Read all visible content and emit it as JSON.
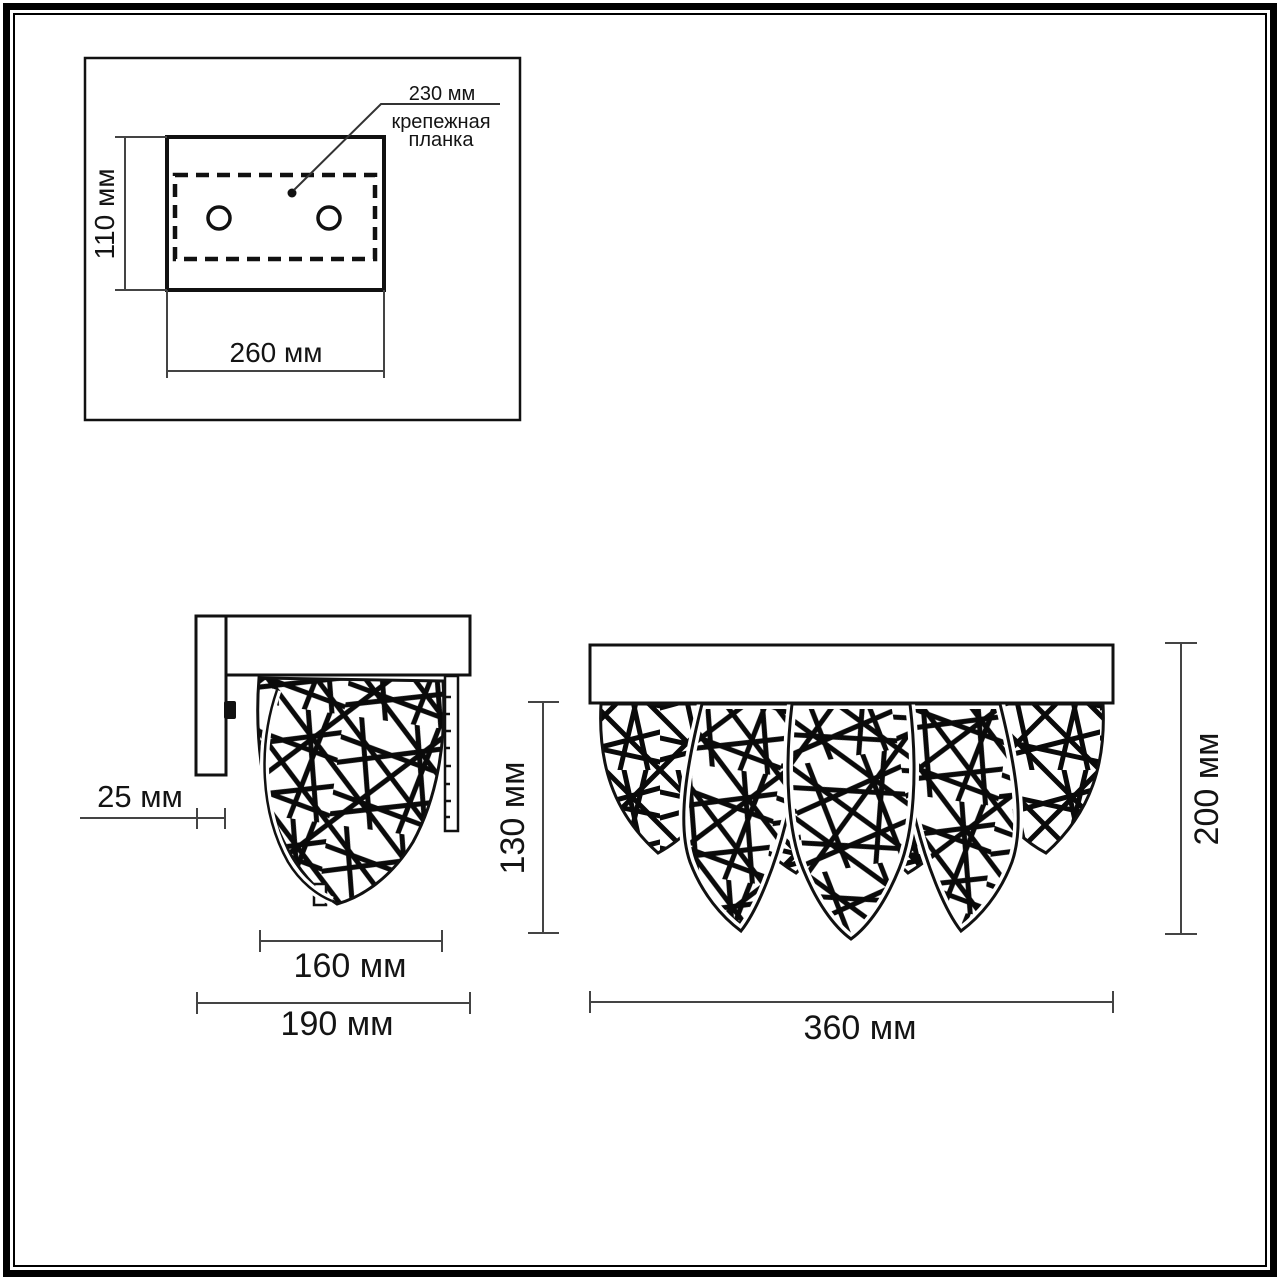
{
  "drawing": {
    "mounting_view": {
      "height_label": "110 мм",
      "width_label": "260 мм",
      "bracket_length_label": "230 мм",
      "bracket_caption_line1": "крепежная",
      "bracket_caption_line2": "планка"
    },
    "side_view": {
      "depth_label": "25 мм",
      "shade_width_label": "160 мм",
      "total_depth_label": "190 мм",
      "shade_height_label": "130 мм"
    },
    "front_view": {
      "width_label": "360 мм",
      "height_label": "200 мм"
    },
    "colors": {
      "line": "#111111",
      "dimension": "#444444",
      "text": "#141414",
      "background": "#ffffff"
    }
  }
}
